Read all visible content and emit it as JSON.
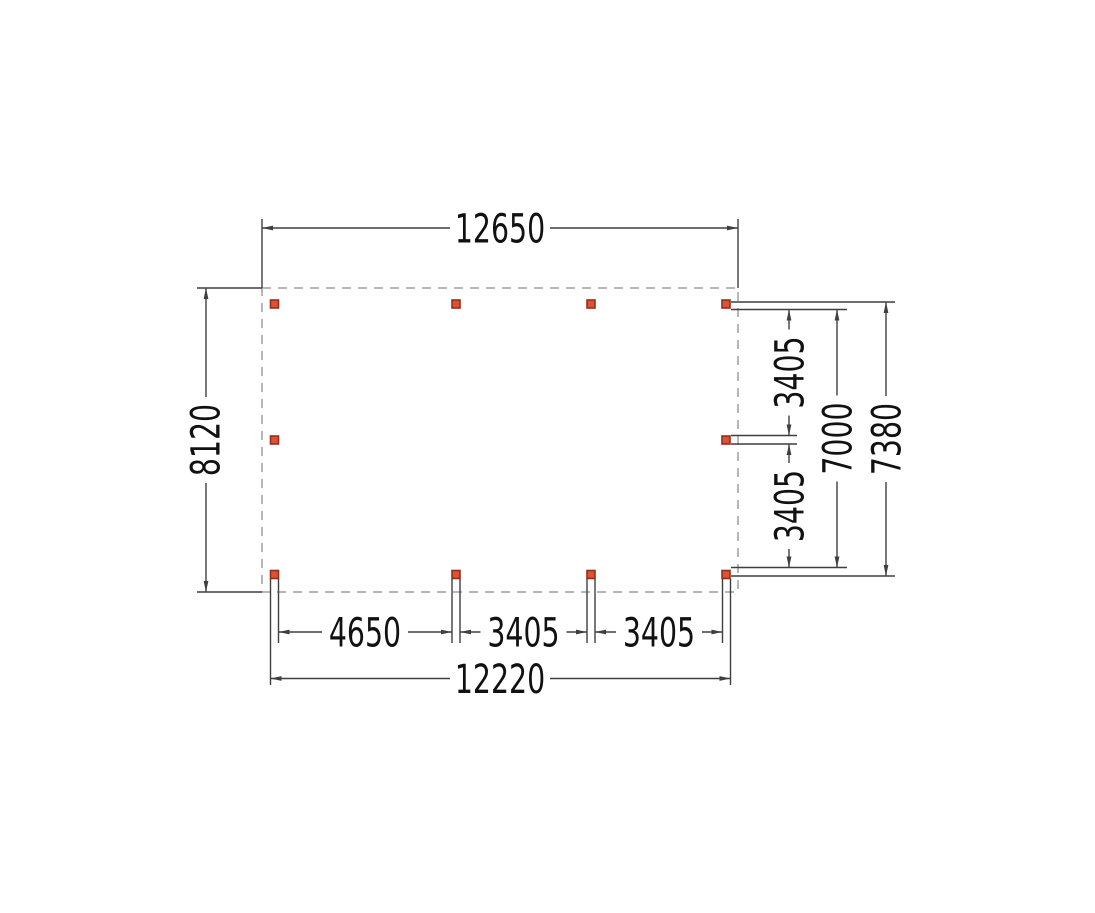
{
  "drawing": {
    "type": "floor-plan-dimension-drawing",
    "posts": {
      "count": 10,
      "shape": "square"
    }
  },
  "dimensions": {
    "top_width": "12650",
    "left_height": "8120",
    "right_bay_upper": "3405",
    "right_bay_lower": "3405",
    "right_span_inner": "7000",
    "right_span_outer": "7380",
    "bottom_bay_first": "4650",
    "bottom_bay_second": "3405",
    "bottom_bay_third": "3405",
    "bottom_span_total": "12220"
  },
  "colors": {
    "background": "#ffffff",
    "dimension_line": "#3f3f3f",
    "outline_dash": "#9f9f9f",
    "post_fill": "#dd5233",
    "post_border": "#942f1f",
    "label_text": "#111111"
  }
}
